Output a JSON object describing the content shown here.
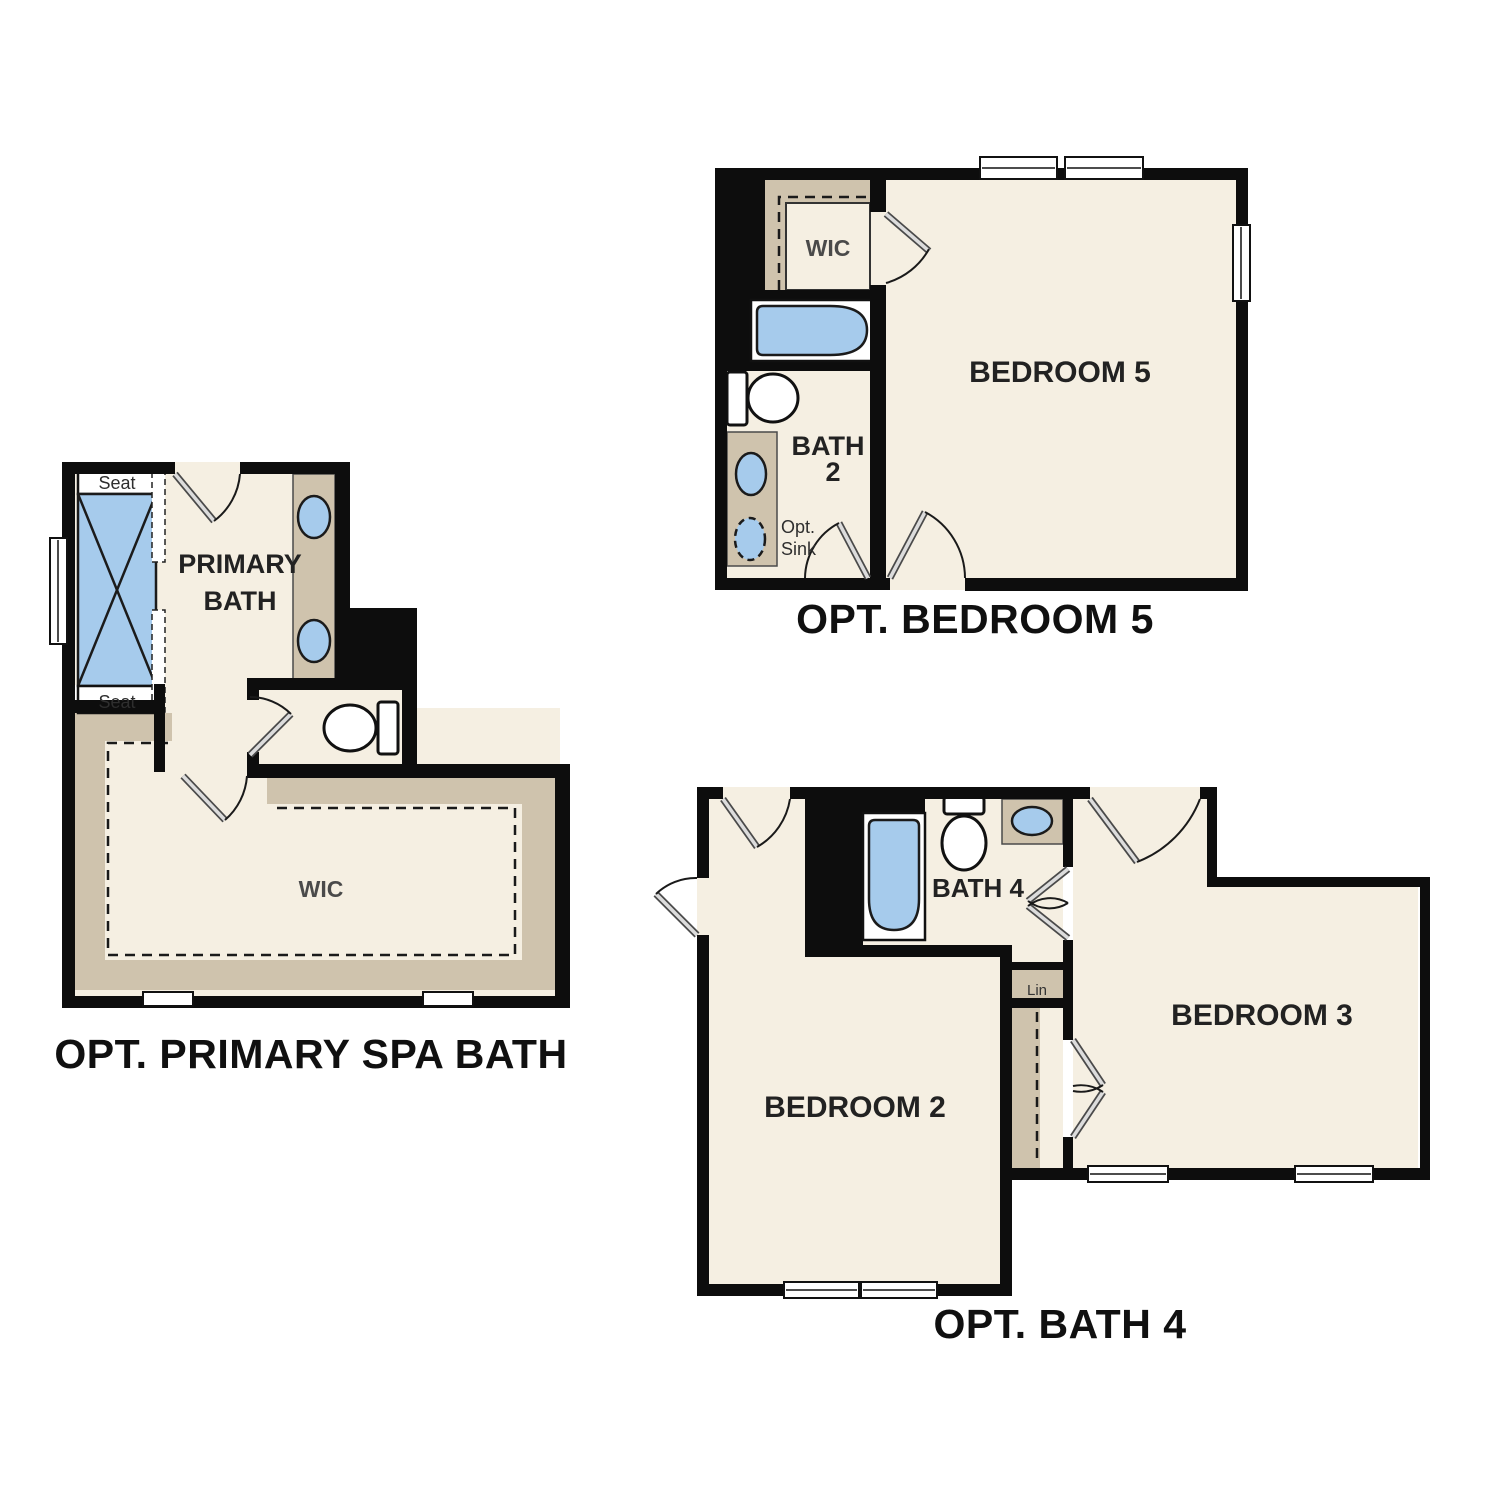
{
  "colors": {
    "floor": "#f5efe2",
    "tan": "#cfc3ad",
    "blue": "#a6cbec",
    "wall": "#0d0d0d"
  },
  "plans": [
    {
      "name": "opt-primary-spa-bath",
      "caption": "OPT. PRIMARY SPA BATH",
      "labels": {
        "primary_bath_line1": "PRIMARY",
        "primary_bath_line2": "BATH",
        "wic": "WIC",
        "seat_top": "Seat",
        "seat_bottom": "Seat"
      },
      "fixtures": [
        "shower-with-seats",
        "double-sink-vanity",
        "toilet",
        "walk-in-closet-shelving",
        "window"
      ]
    },
    {
      "name": "opt-bedroom-5",
      "caption": "OPT. BEDROOM 5",
      "labels": {
        "room": "BEDROOM 5",
        "wic": "WIC",
        "bath_line1": "BATH",
        "bath_line2": "2",
        "opt_sink_line1": "Opt.",
        "opt_sink_line2": "Sink"
      },
      "fixtures": [
        "bathtub",
        "toilet",
        "sink",
        "optional-sink",
        "walk-in-closet",
        "windows"
      ]
    },
    {
      "name": "opt-bath-4",
      "caption": "OPT. BATH 4",
      "labels": {
        "bath": "BATH 4",
        "lin": "Lin",
        "bedroom2": "BEDROOM 2",
        "bedroom3": "BEDROOM 3"
      },
      "fixtures": [
        "bathtub",
        "toilet",
        "sink",
        "linen-closet",
        "bedroom-closet",
        "windows"
      ]
    }
  ]
}
